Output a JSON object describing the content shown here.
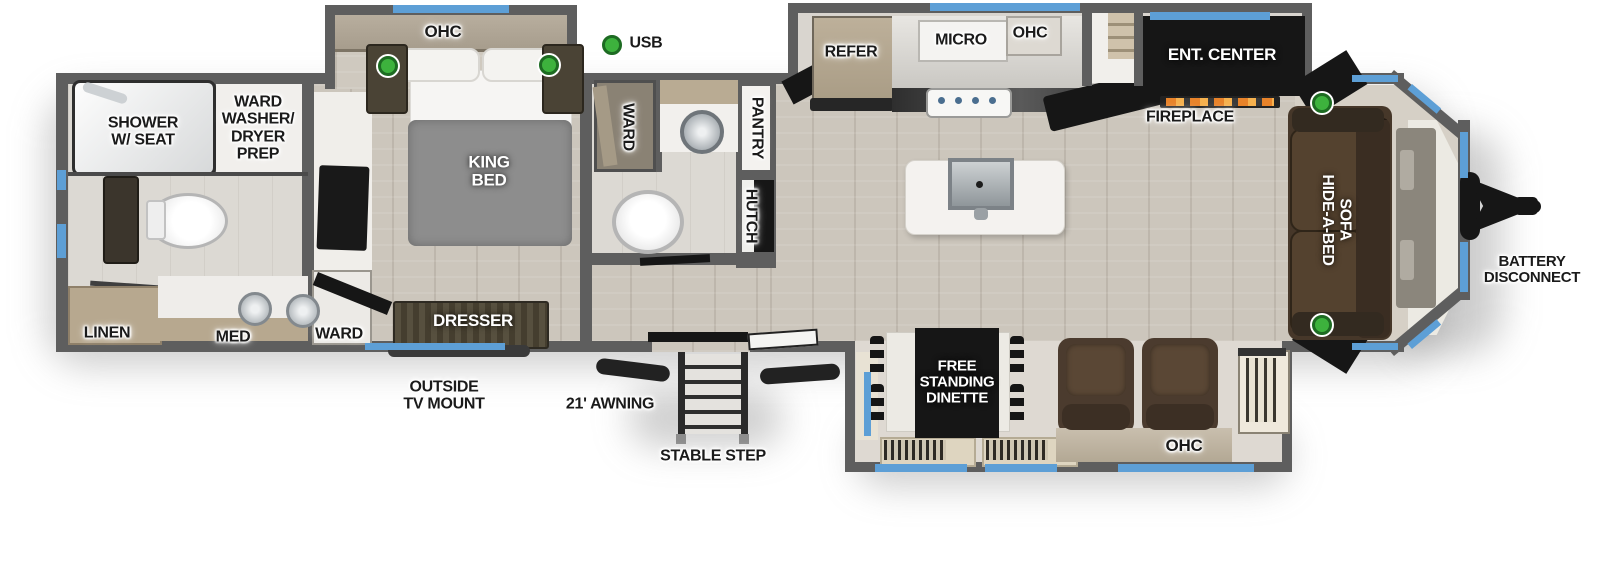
{
  "colors": {
    "wall": "#5e5e5e",
    "window_accent": "#5d9fd6",
    "indicator_green": "#3db23d",
    "black_fixture": "#161616",
    "label_text": "#1a1a1a"
  },
  "legend": {
    "usb": "USB"
  },
  "rooms": {
    "shower": "SHOWER\nW/ SEAT",
    "ward_washer_dryer_prep": "WARD\nWASHER/\nDRYER\nPREP",
    "linen": "LINEN",
    "med": "MED",
    "bedroom_ohc": "OHC",
    "king_bed": "KING\nBED",
    "bedroom_ward": "WARD",
    "dresser": "DRESSER",
    "mid_ward": "WARD",
    "pantry": "PANTRY",
    "hutch": "HUTCH",
    "refer": "REFER",
    "micro": "MICRO",
    "kitchen_ohc": "OHC",
    "ent_center": "ENT. CENTER",
    "fireplace": "FIREPLACE",
    "dinette": "FREE\nSTANDING\nDINETTE",
    "living_ohc": "OHC",
    "hide_a_bed": "HIDE-A-BED\nSOFA"
  },
  "exterior": {
    "outside_tv": "OUTSIDE\nTV MOUNT",
    "awning": "21' AWNING",
    "stable_step": "STABLE STEP",
    "battery": "BATTERY\nDISCONNECT"
  }
}
